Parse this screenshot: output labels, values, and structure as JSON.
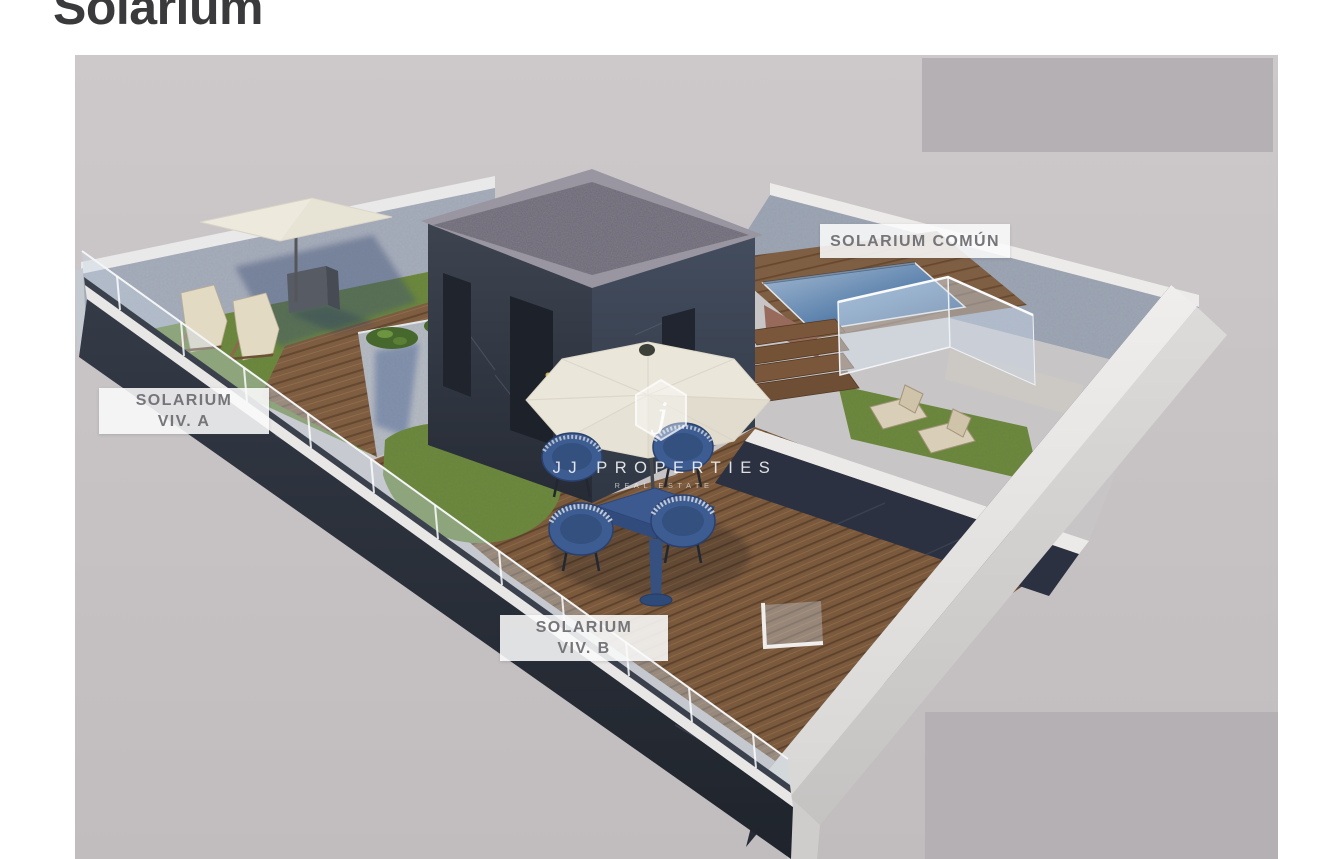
{
  "page": {
    "title": "Solarium"
  },
  "render": {
    "labels": {
      "comun": "SOLARIUM COMÚN",
      "viv_a_line1": "SOLARIUM",
      "viv_a_line2": "VIV. A",
      "viv_b_line1": "SOLARIUM",
      "viv_b_line2": "VIV. B"
    },
    "watermark": {
      "monogram": "j",
      "brand": "JJ PROPERTIES",
      "tagline": "REAL ESTATE"
    }
  },
  "colors": {
    "title_text": "#3a3a3c",
    "canvas_bg": "#cac5c7",
    "overlay_panel": "#b4b0b3",
    "label_text": "#76767a",
    "wall_dark": "#2e3440",
    "wall_stone": "#a7aebc",
    "wall_light": "#d7d5d4",
    "wood_deck": "#7c5b3e",
    "grass": "#6e8a3f",
    "pool_water": "#3c6ca0",
    "umbrella": "#eae6da",
    "furniture_blue": "#3d5c91",
    "watermark_white": "#ffffff"
  }
}
